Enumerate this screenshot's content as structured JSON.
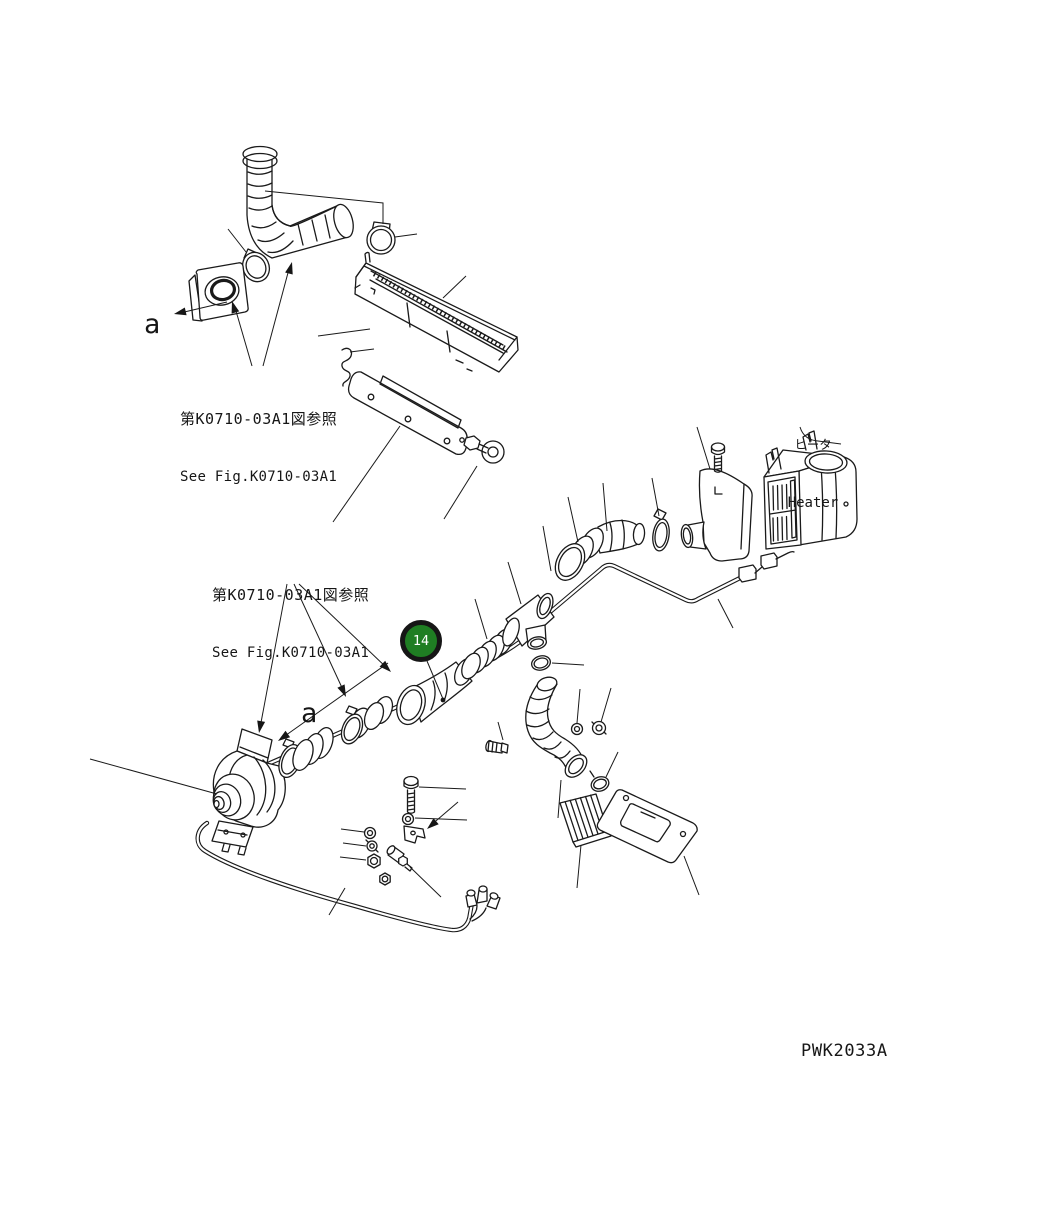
{
  "page": {
    "background": "#ffffff",
    "line_color": "#1a1a1a"
  },
  "labels": {
    "ref_note_top": {
      "jp": "第K0710-03A1図参照",
      "en": "See Fig.K0710-03A1"
    },
    "ref_note_mid": {
      "jp": "第K0710-03A1図参照",
      "en": "See Fig.K0710-03A1"
    },
    "heater": {
      "jp": "ヒータ",
      "en": "Heater"
    },
    "view_a_top": "a",
    "view_a_mid": "a",
    "drawing_code": "PWK2033A"
  },
  "callout": {
    "number": "14",
    "fill": "#1f7e23",
    "ring": "#161616",
    "text_color": "#ffffff"
  }
}
